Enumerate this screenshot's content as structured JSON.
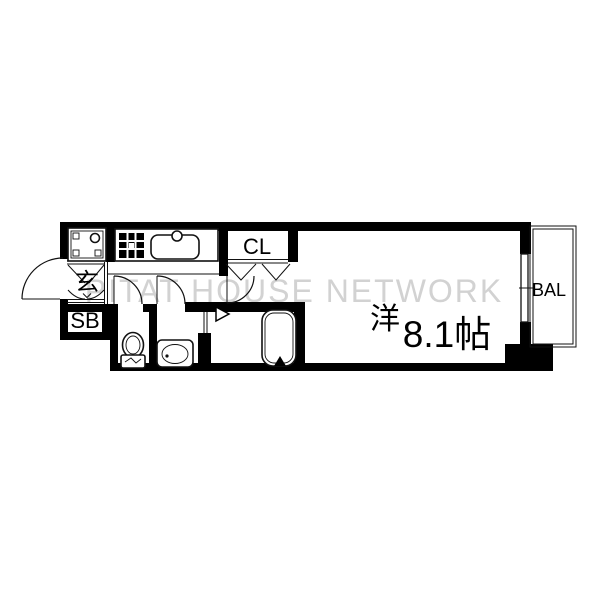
{
  "page": {
    "type": "real-estate-floor-plan",
    "background": "#ffffff"
  },
  "watermark": {
    "text": "PITAT HOUSE NETWORK",
    "color": "#d2d2d2"
  },
  "rooms": {
    "entrance_label": "玄",
    "shoe_box_label": "SB",
    "closet_label": "CL",
    "balcony_label": "BAL",
    "main_room_type": "洋",
    "main_room_size": "8.1帖"
  },
  "icons": [
    "laundry-pan-icon",
    "stove-icon",
    "kitchen-sink-icon",
    "toilet-icon",
    "washbasin-icon",
    "bathtub-icon",
    "entrance-door-arc-icon",
    "interior-door-arc-icon",
    "closet-folding-door-icon",
    "sliding-window-icon",
    "bathroom-door-marker-icon"
  ],
  "colors": {
    "wall": "#000000",
    "line": "#111111",
    "watermark": "#d2d2d2",
    "background": "#ffffff"
  }
}
